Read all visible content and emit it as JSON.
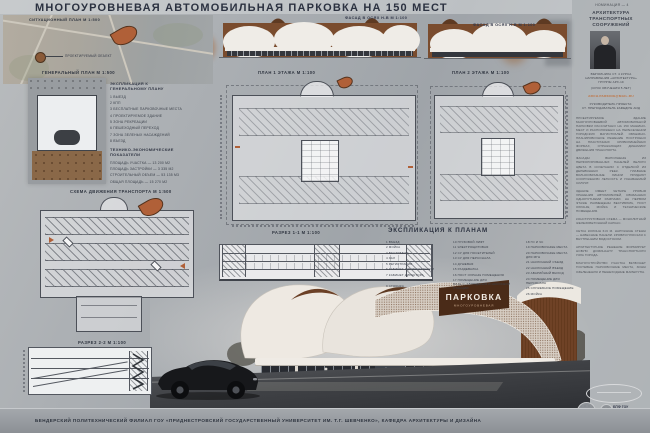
{
  "colors": {
    "accent": "#b06038",
    "brown": "#6f4226",
    "paper": "#aab0b5",
    "ink": "#2e3440",
    "glass": "#282b31"
  },
  "header": {
    "title": "МНОГОУРОВНЕВАЯ АВТОМОБИЛЬНАЯ ПАРКОВКА НА 150  МЕСТ",
    "nomination": "НОМИНАЦИЯ — 4"
  },
  "labels": {
    "situational_plan": "СИТУАЦИОННЫЙ ПЛАН М 1:500",
    "projected_object": "ПРОЕКТИРУЕМЫЙ ОБЪЕКТ",
    "general_plan": "ГЕНЕРАЛЬНЫЙ ПЛАН М 1:500",
    "transport_scheme": "СХЕМА ДВИЖЕНИЯ ТРАНСПОРТА М 1:500",
    "section_2": "РАЗРЕЗ 2-2 М 1:100",
    "facade_1": "ФАСАД В ОСЯХ Н-В М 1:100",
    "facade_2": "ФАСАД В ОСЯХ Н-В М 1:100",
    "plan_floor1": "ПЛАН 1 ЭТАЖА М 1:100",
    "plan_floor2": "ПЛАН 2 ЭТАЖА М 1:100",
    "section_1": "РАЗРЕЗ 1-1 М 1:100"
  },
  "genplan_expl": {
    "heading_line1": "ЭКСПЛИКАЦИЯ К",
    "heading_line2": "ГЕНЕРАЛЬНОМУ ПЛАНУ",
    "items": [
      "1  ВЫЕЗД",
      "2  КПП",
      "3  БЕСПЛАТНЫЕ ПАРКОВОЧНЫЕ МЕСТА",
      "4  ПРОЕКТИРУЕМОЕ ЗДАНИЕ",
      "5  ЗОНА РЕКРЕАЦИИ",
      "6  ПЕШЕХОДНЫЙ ПЕРЕХОД",
      "7  ЗОНА ЗЕЛЕНЫХ НАСАЖДЕНИЙ",
      "8  ВЪЕЗД"
    ]
  },
  "tep": {
    "heading_line1": "ТЕХНИКО-ЭКОНОМИЧЕСКИЕ",
    "heading_line2": "ПОКАЗАТЕЛИ",
    "items": [
      "ПЛОЩАДЬ УЧАСТКА — 13 200 М2",
      "ПЛОЩАДЬ ЗАСТРОЙКИ — 3 335 М2",
      "СТРОИТЕЛЬНЫЙ ОБЪЕМ — 53 135 М3",
      "ОБЩАЯ ПЛОЩАДЬ — 15 270 М2"
    ]
  },
  "plans_expl": {
    "heading": "ЭКСПЛИКАЦИЯ К ПЛАНАМ",
    "col1": [
      "1  ВЪЕЗД",
      "2  МОЙКА",
      "3  ВЕСТИБЮЛЬ",
      "4  ЗАЛ",
      "5  РЕГИСТРАЦИЯ",
      "6  КАБИНЕТ АДМИНИСТРАЦИИ",
      "7  КАБИНЕТ ДИРЕКТОРА",
      "8  БУФЕТ",
      "9  СТОЯНКА"
    ],
    "col2": [
      "10  ГРУЗОВОЙ ЛИФТ",
      "11  ЭЛЕКТРОЩИТОВАЯ",
      "12  СУ ДЛЯ ПОСЕТИТЕЛЕЙ",
      "13  СУ ДЛЯ ПЕРСОНАЛА",
      "14  ДУШЕВАЯ",
      "15  РАЗДЕВАЛКА",
      "16  ПОСТ ОХРАНЫ ПОМЕЩЕНИЯ",
      "17  ПОМЕЩЕНИЕ ДЛЯ ВИДЕОНАБЛЮДЕНИЯ И НАСОСНОЙ СТАНЦИИ"
    ],
    "col3": [
      "18  ГО И ЧС",
      "19  ПАРКОВОЧНЫЕ МЕСТА",
      "20  ПАРКОВОЧНЫЕ МЕСТА ДЛЯ МГН",
      "21  НАКЛОННЫЙ СЪЕЗД",
      "22  НАКЛОННЫЙ ВЪЕЗД",
      "23  АВАРИЙНЫЙ ВЫХОД",
      "24  ПОМЕЩЕНИЕ ДЛЯ ПЕРСОНАЛА",
      "25  СЛУЖЕБНОЕ ПОМЕЩЕНИЕ",
      "26  МОЙКА"
    ]
  },
  "sign": {
    "line1": "ПАРКОВКА",
    "line2": "МНОГОУРОВНЕВАЯ"
  },
  "sidebar": {
    "category": "АРХИТЕКТУРА ТРАНСПОРТНЫХ СООРУЖЕНИЙ",
    "author_lines": [
      "ВЫПОЛНИЛА СТ. 4 КУРСА",
      "НАПРАВЛЕНИЯ «АРХИТЕКТУРА»",
      "ГРУППЫ АРХ-19"
    ],
    "term_line": "(СРОК ОБУЧЕНИЯ 5 ЛЕТ)",
    "email": "ARCH.PARKING@MAIL.RU",
    "supervisor_lines": [
      "РУКОВОДИТЕЛЬ ПРОЕКТА:",
      "СТ. ПРЕПОДАВАТЕЛЬ КАФЕДРЫ АИД"
    ],
    "paragraphs": [
      "ПРОЕКТИРУЕМОЕ ЗДАНИЕ МНОГОУРОВНЕВОЙ АВТОМОБИЛЬНОЙ ПАРКОВКИ РАССЧИТАНО НА 150 МАШИНО-МЕСТ И РАСПОЛОЖЕНО НА ПЕРЕСЕЧЕНИИ ГОРОДСКИХ МАГИСТРАЛЕЙ. ОБЪЕМНО-ПЛАНИРОВОЧНОЕ РЕШЕНИЕ ПОСТРОЕНО НА ПЛАСТИЧНЫХ КРИВОЛИНЕЙНЫХ ФОРМАХ, ОТРАЖАЮЩИХ ДИНАМИКУ ДВИЖЕНИЯ ТРАНСПОРТА.",
      "ФАСАДЫ ВЫПОЛНЕНЫ ИЗ ПЕРФОРИРОВАННЫХ ПАНЕЛЕЙ БЕЛОГО ЦВЕТА В СОЧЕТАНИИ С ОТДЕЛКОЙ ИЗ ДЕРЕВЯННЫХ РЕЕК. ПЛАВНЫЕ ВОЛНООБРАЗНЫЕ ЛИНИИ ПРИДАЮТ СООРУЖЕНИЮ ЛЕГКОСТЬ И УЗНАВАЕМЫЙ СИЛУЭТ.",
      "ЗДАНИЕ ИМЕЕТ ЧЕТЫРЕ УРОВНЯ ХРАНЕНИЯ АВТОМОБИЛЕЙ, СВЯЗАННЫХ ОДНОПУТНЫМИ РАМПАМИ. НА ПЕРВОМ ЭТАЖЕ РАЗМЕЩЕНЫ ВЕСТИБЮЛЬ, ПОСТ ОХРАНЫ, МОЙКА И ТЕХНИЧЕСКИЕ ПОМЕЩЕНИЯ.",
      "КОНСТРУКТИВНАЯ СХЕМА — МОНОЛИТНЫЙ ЖЕЛЕЗОБЕТОННЫЙ КАРКАС.",
      "СЕТКА КОЛОНН 6×6 М. НАРУЖНЫЕ СТЕНЫ — НАВЕСНЫЕ ПАНЕЛИ. КРОВЛЯ ПЛОСКАЯ С ВНУТРЕННИМ ВОДОСТОКОМ.",
      "АРХИТЕКТУРНОЕ РЕШЕНИЕ ФОРМИРУЕТ НОВУЮ ДОМИНАНТУ ТРАНСПОРТНОГО УЗЛА ГОРОДА.",
      "БЛАГОУСТРОЙСТВО УЧАСТКА ВКЛЮЧАЕТ ГОСТЕВЫЕ ПАРКОВОЧНЫЕ МЕСТА, ЗОНЫ ОЗЕЛЕНЕНИЯ И ПЕШЕХОДНЫЕ МАРШРУТЫ."
    ]
  },
  "footer": {
    "caption": "БЕНДЕРСКИЙ ПОЛИТЕХНИЧЕСКИЙ ФИЛИАЛ ГОУ «ПРИДНЕСТРОВСКИЙ ГОСУДАРСТВЕННЫЙ УНИВЕРСИТЕТ ИМ. Т.Г. ШЕВЧЕНКО», КАФЕДРА АРХИТЕКТУРЫ И ДИЗАЙНА",
    "logo_title": "БПФ ГОУ",
    "logo_subtitle": "«ПГУ ИМ. Т.Г. ШЕВЧЕНКО»"
  }
}
